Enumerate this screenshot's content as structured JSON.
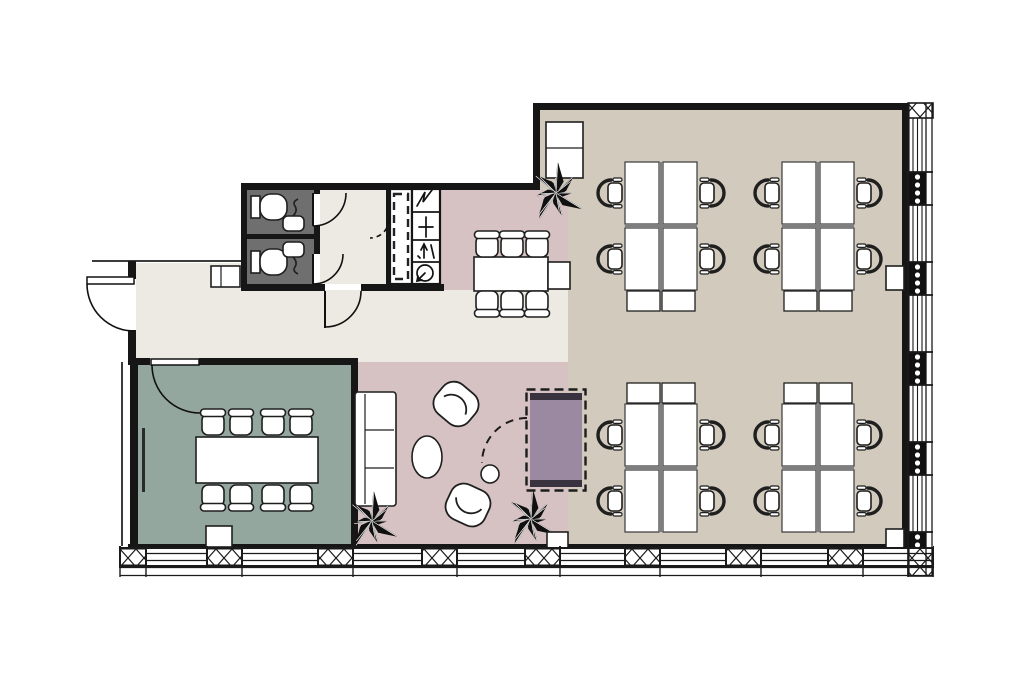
{
  "colors": {
    "canvas": "#ffffff",
    "wall": "#161616",
    "thin": "#3c3c3c",
    "corridor": "#edeae3",
    "office": "#d2cabd",
    "pink": "#d7c2c3",
    "meeting": "#94a79f",
    "wc": "#6f6f6f",
    "furniture": "#ffffff",
    "furnline": "#1f1f1f",
    "divider": "#7e7e7e",
    "accent": "#9b88a1",
    "accentdark": "#39323f",
    "winline": "#1a1a1a",
    "plant": "#101010"
  },
  "plan": {
    "rooms": [
      {
        "n": "open-office-area",
        "fill": "office",
        "poly": [
          [
            540,
            110
          ],
          [
            902,
            110
          ],
          [
            902,
            545
          ],
          [
            568,
            545
          ],
          [
            568,
            190
          ],
          [
            540,
            190
          ]
        ]
      },
      {
        "n": "dining-area",
        "fill": "pink",
        "rect": [
          440,
          190,
          128,
          102
        ]
      },
      {
        "n": "lounge-area",
        "fill": "pink",
        "rect": [
          358,
          362,
          210,
          183
        ]
      },
      {
        "n": "corridor",
        "fill": "corridor",
        "rect": [
          136,
          263,
          109,
          99
        ]
      },
      {
        "n": "corridor",
        "fill": "corridor",
        "rect": [
          245,
          290,
          323,
          72
        ]
      },
      {
        "n": "wc-lobby",
        "fill": "corridor",
        "rect": [
          320,
          190,
          66,
          94
        ]
      },
      {
        "n": "wc-stalls",
        "fill": "wc",
        "rect": [
          247,
          190,
          67,
          94
        ]
      },
      {
        "n": "meeting-room",
        "fill": "meeting",
        "rect": [
          138,
          365,
          213,
          180
        ]
      }
    ],
    "thin_lines": [
      [
        92,
        261,
        245,
        261
      ],
      [
        122,
        362,
        122,
        546
      ]
    ],
    "walls": [
      [
        241,
        183,
        299,
        7
      ],
      [
        533,
        103,
        375,
        7
      ],
      [
        533,
        103,
        7,
        87
      ],
      [
        241,
        183,
        6,
        107
      ],
      [
        241,
        284,
        84,
        7
      ],
      [
        361,
        284,
        83,
        7
      ],
      [
        314,
        189,
        6,
        5
      ],
      [
        314,
        226,
        6,
        28
      ],
      [
        247,
        234,
        67,
        5
      ],
      [
        386,
        189,
        5,
        95
      ],
      [
        128,
        261,
        8,
        18
      ],
      [
        128,
        330,
        8,
        35
      ],
      [
        137,
        358,
        13,
        7
      ],
      [
        199,
        358,
        159,
        7
      ],
      [
        130,
        358,
        8,
        190
      ],
      [
        351,
        358,
        7,
        190
      ],
      [
        902,
        103,
        6,
        445
      ],
      [
        128,
        544,
        780,
        3
      ]
    ],
    "core": {
      "shaft_outline": [
        390,
        189,
        22,
        95
      ],
      "shaft_dashed": [
        394,
        194,
        14,
        85
      ],
      "riser_outline": [
        412,
        189,
        28,
        95
      ],
      "riser_dividers": [
        [
          412,
          212,
          440,
          212
        ],
        [
          412,
          240,
          440,
          240
        ],
        [
          412,
          262,
          440,
          262
        ]
      ],
      "riser_symbols": [
        {
          "n": "electrical-riser-icon",
          "d": "M417,206 L425,192 L423,202 L432,190"
        },
        {
          "n": "plumbing-riser-icon",
          "d": "M426,217 L426,237 M419,227 L433,227"
        },
        {
          "n": "duct-riser-icon",
          "d": "M424,258 L424,245 M421,250 L424,244 L427,250 M431,245 L434,258 M418,256 L420,258"
        },
        {
          "n": "ventilation-riser-icon",
          "d": "M433,273 A8,8 0 1 0 417,273 A8,8 0 0 0 433,273 M425,273 L417,281 M418,276 L417,281 L422,280"
        }
      ]
    },
    "furniture": [
      {
        "n": "meeting-table",
        "t": "rect",
        "r": [
          196,
          437,
          122,
          46
        ]
      },
      {
        "n": "conference-chair",
        "t": "cchair",
        "c": [
          213,
          423
        ],
        "rot": 0
      },
      {
        "n": "conference-chair",
        "t": "cchair",
        "c": [
          241,
          423
        ],
        "rot": 0
      },
      {
        "n": "conference-chair",
        "t": "cchair",
        "c": [
          273,
          423
        ],
        "rot": 0
      },
      {
        "n": "conference-chair",
        "t": "cchair",
        "c": [
          301,
          423
        ],
        "rot": 0
      },
      {
        "n": "conference-chair",
        "t": "cchair",
        "c": [
          213,
          497
        ],
        "rot": 180
      },
      {
        "n": "conference-chair",
        "t": "cchair",
        "c": [
          241,
          497
        ],
        "rot": 180
      },
      {
        "n": "conference-chair",
        "t": "cchair",
        "c": [
          273,
          497
        ],
        "rot": 180
      },
      {
        "n": "conference-chair",
        "t": "cchair",
        "c": [
          301,
          497
        ],
        "rot": 180
      },
      {
        "n": "whiteboard",
        "t": "bar",
        "r": [
          142,
          428,
          3,
          64
        ]
      },
      {
        "n": "floor-box",
        "t": "rect",
        "r": [
          206,
          526,
          26,
          21
        ]
      },
      {
        "n": "sofa",
        "t": "sofa",
        "r": [
          355,
          392,
          41,
          114
        ]
      },
      {
        "n": "armchair",
        "t": "armchair",
        "c": [
          456,
          404
        ],
        "rot": 40
      },
      {
        "n": "armchair",
        "t": "armchair",
        "c": [
          468,
          505
        ],
        "rot": 205
      },
      {
        "n": "coffee-table",
        "t": "ellipse",
        "c": [
          427,
          457
        ],
        "rx": 15,
        "ry": 21
      },
      {
        "n": "side-table",
        "t": "circle",
        "c": [
          490,
          474
        ],
        "r": 9
      },
      {
        "n": "dining-table",
        "t": "rect",
        "r": [
          474,
          257,
          74,
          34
        ]
      },
      {
        "n": "dining-side-table",
        "t": "rect",
        "r": [
          548,
          262,
          22,
          27
        ]
      },
      {
        "n": "conference-chair",
        "t": "cchair",
        "c": [
          487,
          245
        ],
        "rot": 0
      },
      {
        "n": "conference-chair",
        "t": "cchair",
        "c": [
          512,
          245
        ],
        "rot": 0
      },
      {
        "n": "conference-chair",
        "t": "cchair",
        "c": [
          537,
          245
        ],
        "rot": 0
      },
      {
        "n": "conference-chair",
        "t": "cchair",
        "c": [
          487,
          303
        ],
        "rot": 180
      },
      {
        "n": "conference-chair",
        "t": "cchair",
        "c": [
          512,
          303
        ],
        "rot": 180
      },
      {
        "n": "conference-chair",
        "t": "cchair",
        "c": [
          537,
          303
        ],
        "rot": 180
      },
      {
        "n": "tall-cabinet",
        "t": "cab",
        "r": [
          546,
          122,
          37,
          56
        ],
        "lines": [
          [
            546,
            148,
            583,
            148
          ]
        ]
      },
      {
        "n": "storage-bench",
        "t": "cab",
        "r": [
          211,
          266,
          29,
          21
        ],
        "lines": [
          [
            221,
            266,
            221,
            287
          ]
        ]
      },
      {
        "n": "wall-cabinet",
        "t": "rect",
        "r": [
          886,
          266,
          18,
          24
        ]
      },
      {
        "n": "wall-cabinet",
        "t": "rect",
        "r": [
          886,
          529,
          18,
          24
        ]
      },
      {
        "n": "toilet-cistern",
        "t": "rect",
        "r": [
          251,
          196,
          9,
          22
        ]
      },
      {
        "n": "toilet-bowl",
        "t": "rect",
        "r": [
          260,
          194,
          27,
          26
        ],
        "rx": 11
      },
      {
        "n": "toilet-cistern",
        "t": "rect",
        "r": [
          251,
          251,
          9,
          22
        ]
      },
      {
        "n": "toilet-bowl",
        "t": "rect",
        "r": [
          260,
          249,
          27,
          26
        ],
        "rx": 11
      },
      {
        "n": "sink",
        "t": "rect",
        "r": [
          283,
          216,
          21,
          15
        ],
        "rx": 5
      },
      {
        "n": "sink",
        "t": "rect",
        "r": [
          283,
          242,
          21,
          15
        ],
        "rx": 5
      },
      {
        "n": "faucet",
        "t": "path",
        "d": "M293,216 q5,-5 2,-10 q-3,-4 3,-7",
        "sw": 1.6
      },
      {
        "n": "faucet",
        "t": "path",
        "d": "M293,257 q5,5 2,10 q-3,4 3,7",
        "sw": 1.6
      },
      {
        "n": "desk-cluster",
        "t": "cluster",
        "x": 625,
        "y": 162,
        "cab": "bottom"
      },
      {
        "n": "desk-cluster",
        "t": "cluster",
        "x": 782,
        "y": 162,
        "cab": "bottom"
      },
      {
        "n": "desk-cluster",
        "t": "cluster",
        "x": 625,
        "y": 404,
        "cab": "top"
      },
      {
        "n": "desk-cluster",
        "t": "cluster",
        "x": 782,
        "y": 404,
        "cab": "top"
      },
      {
        "n": "plant",
        "t": "plant",
        "c": [
          556,
          193
        ],
        "r": 30
      },
      {
        "n": "plant",
        "t": "plant",
        "c": [
          372,
          521
        ],
        "r": 29
      },
      {
        "n": "plant",
        "t": "plant",
        "c": [
          531,
          519
        ],
        "r": 29
      },
      {
        "n": "lounge-corner-box",
        "t": "rect",
        "r": [
          547,
          532,
          21,
          17
        ]
      }
    ],
    "accent_table": {
      "n": "accent-table",
      "dash_rect": [
        526.5,
        389.5,
        59,
        101
      ],
      "fill_rect": [
        530,
        393,
        52,
        94
      ],
      "end_bars": [
        [
          530,
          393,
          52,
          7
        ],
        [
          530,
          480,
          52,
          7
        ]
      ],
      "swing": "M527,418 A45,45 0 0 0 482,463"
    },
    "doors": [
      {
        "n": "entrance-door",
        "leaf_rect": [
          87,
          277,
          47,
          7
        ],
        "arc": "M87,284 A47,47 0 0 0 134,331"
      },
      {
        "n": "corridor-door",
        "leaf": [
          325,
          291,
          325,
          328
        ],
        "arc": "M361,291 A36,36 0 0 1 325,327"
      },
      {
        "n": "meeting-room-door",
        "leaf_rect": [
          151,
          359,
          48,
          6
        ],
        "arc": "M152,365 A48,48 0 0 0 200,413"
      },
      {
        "n": "wc-door",
        "leaf": [
          313,
          193,
          313,
          226
        ],
        "arc": "M313,226 A33,33 0 0 0 346,193"
      },
      {
        "n": "wc-door",
        "leaf": [
          313,
          254,
          313,
          284
        ],
        "arc": "M313,284 A30,30 0 0 0 343,254"
      },
      {
        "n": "shaft-door",
        "arc": "M389,219 A19,19 0 0 1 370,238",
        "dash": true
      }
    ],
    "window_bottom": {
      "x1": 120,
      "x2": 933,
      "y": 548,
      "h": 18,
      "inner_lines": [
        553.5,
        560.5
      ],
      "xpanels": [
        [
          120,
          26
        ],
        [
          207,
          35
        ],
        [
          318,
          35
        ],
        [
          422,
          35
        ],
        [
          525,
          35
        ],
        [
          625,
          35
        ],
        [
          726,
          35
        ],
        [
          828,
          35
        ]
      ],
      "sill": {
        "y1": 567.5,
        "y2": 575.5,
        "ticks": [
          120,
          146,
          242,
          353,
          457,
          560,
          660,
          761,
          863,
          908,
          933
        ]
      }
    },
    "window_right": {
      "x": 908,
      "w": 25,
      "y1": 103,
      "y2": 548,
      "edges": [
        908.5,
        926,
        932
      ],
      "glaze_xs": [
        913,
        917.5,
        922
      ],
      "dot_segs": [
        [
          172,
          33
        ],
        [
          262,
          33
        ],
        [
          352,
          33
        ],
        [
          442,
          33
        ],
        [
          532,
          16
        ]
      ],
      "cap": [
        908,
        103,
        25,
        15
      ],
      "corner": [
        908,
        548,
        25,
        28
      ]
    }
  }
}
